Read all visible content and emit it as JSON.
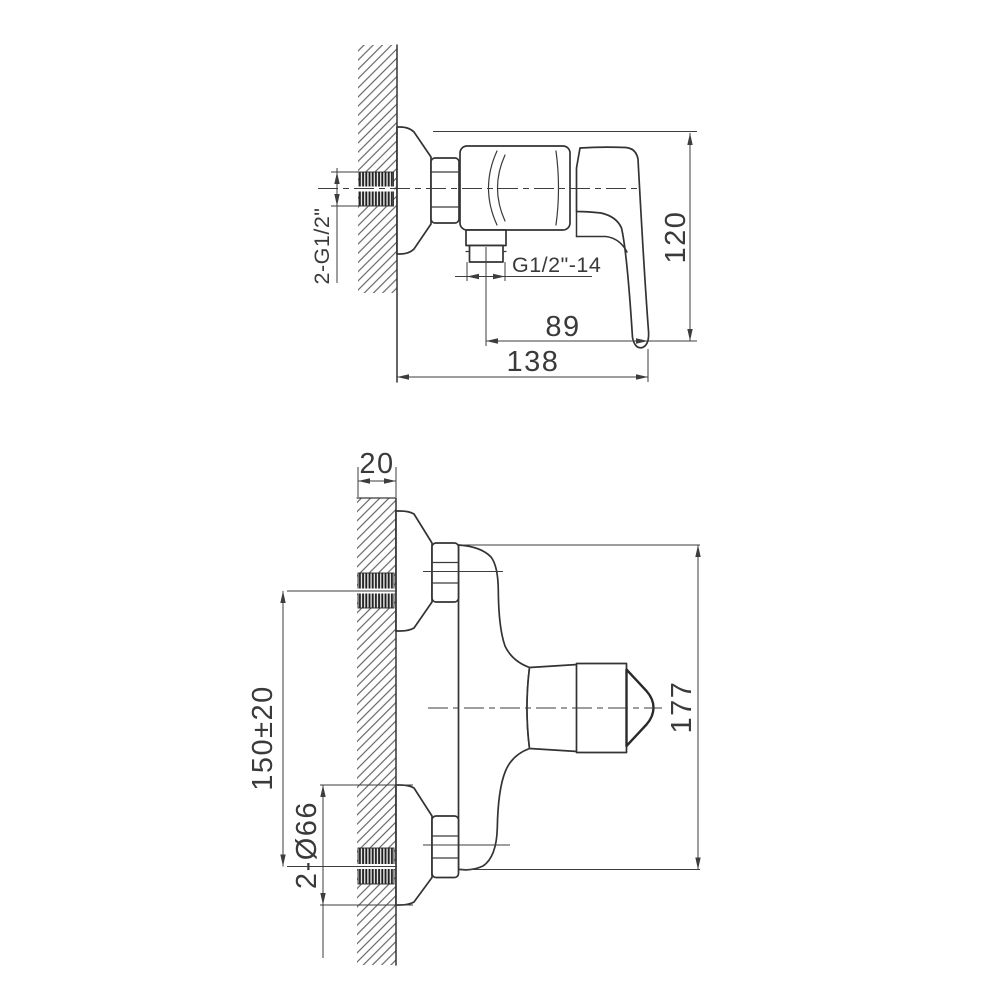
{
  "drawing": {
    "type": "faucet-installation-dimensions",
    "background": "#ffffff",
    "line_color": "#333333",
    "views": {
      "side_view": {
        "name": "side view (wall-mounted shower mixer, profile)",
        "labels": {
          "wall_thread": "2-G1/2\"",
          "outlet_thread": "G1/2\"-14",
          "spout_to_tip": "89",
          "wall_to_tip": "138",
          "height": "120"
        }
      },
      "front_view": {
        "name": "front/top view (inlets on wall)",
        "labels": {
          "wall_thickness": "20",
          "inlet_spacing": "150±20",
          "escutcheon_diameter": "2-Ø66",
          "total_height": "177"
        }
      }
    }
  }
}
